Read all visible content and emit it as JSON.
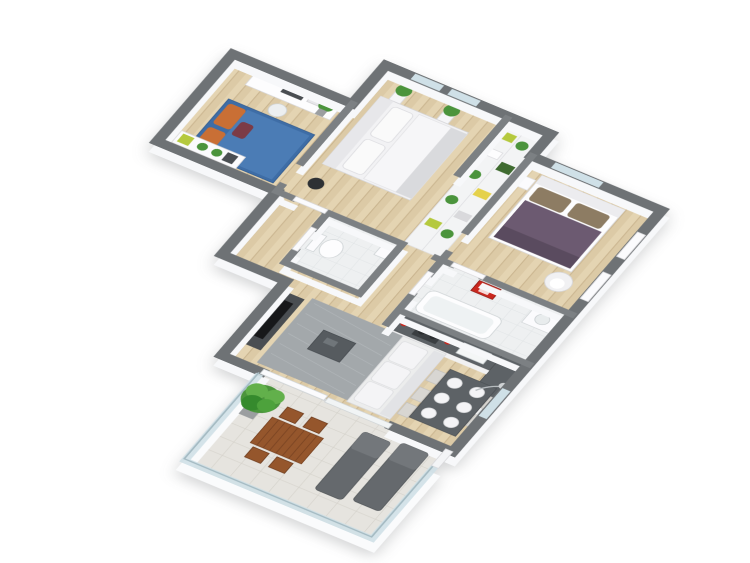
{
  "scene": {
    "type": "isometric-3d-apartment-floor-plan",
    "background": "#ffffff",
    "rooms": [
      {
        "id": "bedroom-1",
        "furniture": [
          "blue double bed with orange pillows",
          "white desk with monitor",
          "desk chair",
          "green wall art",
          "low shelf with plants",
          "potted plant"
        ]
      },
      {
        "id": "bedroom-2",
        "furniture": [
          "white double bed",
          "two potted plants at windows",
          "black stool"
        ]
      },
      {
        "id": "closet",
        "furniture": [
          "open shelving with plants, boxes, lime and yellow bins"
        ]
      },
      {
        "id": "bedroom-3",
        "furniture": [
          "purple double bed with brown pillows",
          "green panoramic wall art",
          "white round armchair",
          "white door"
        ]
      },
      {
        "id": "wc",
        "furniture": [
          "toilet",
          "small sink"
        ]
      },
      {
        "id": "bathroom",
        "furniture": [
          "bathtub",
          "red wall cabinet",
          "washbasin counter"
        ]
      },
      {
        "id": "kitchen",
        "furniture": [
          "L-shaped counter with dark top",
          "sink",
          "stove",
          "red kettle",
          "fridge"
        ]
      },
      {
        "id": "living-dining",
        "furniture": [
          "tv stand with tv",
          "gray rug",
          "dark coffee table",
          "white sofa",
          "dark dining table with six white plates",
          "light dining chairs",
          "floor lamp"
        ]
      },
      {
        "id": "balcony",
        "furniture": [
          "glass railing",
          "round potted tree",
          "wooden outdoor table",
          "wooden outdoor chairs",
          "two gray sun loungers",
          "sliding glass door"
        ]
      }
    ],
    "palette": {
      "wallCap": "#6e7275",
      "wallCapInt": "#7c8083",
      "wallFace": "#f7f8fa",
      "woodBase": "#dccaa6",
      "woodStripe": "#e4d4b2",
      "woodLine": "#c9b48e",
      "tileBase": "#eef0f1",
      "tileLine": "#dfe3e5",
      "outBase": "#e6e4df",
      "outLine": "#d3d0c9",
      "glass": "#cfe0e7",
      "glassEdge": "#a4bac2",
      "blue": "#3e6da6",
      "blueLight": "#4b7cb5",
      "orange": "#c96f35",
      "maroon": "#7c3b46",
      "purple": "#6c5a71",
      "purpleDark": "#5a4b5f",
      "tan": "#8d7c63",
      "green": "#4b943c",
      "greenLight": "#62b04b",
      "greenDark": "#3f6b30",
      "lime": "#b5c93e",
      "yellow": "#e5d14b",
      "charcoal": "#4a4e52",
      "slate": "#5d6266",
      "rug": "#a3a8ab",
      "red": "#c9281f",
      "brown": "#95562c",
      "brownDark": "#7a4423",
      "lounger": "#65696d",
      "pot": "#9b9ea0",
      "white": "#f4f4f6",
      "softWhite": "#fbfbfd",
      "shadowGray": "#d9dadd",
      "black": "#17181a"
    }
  }
}
